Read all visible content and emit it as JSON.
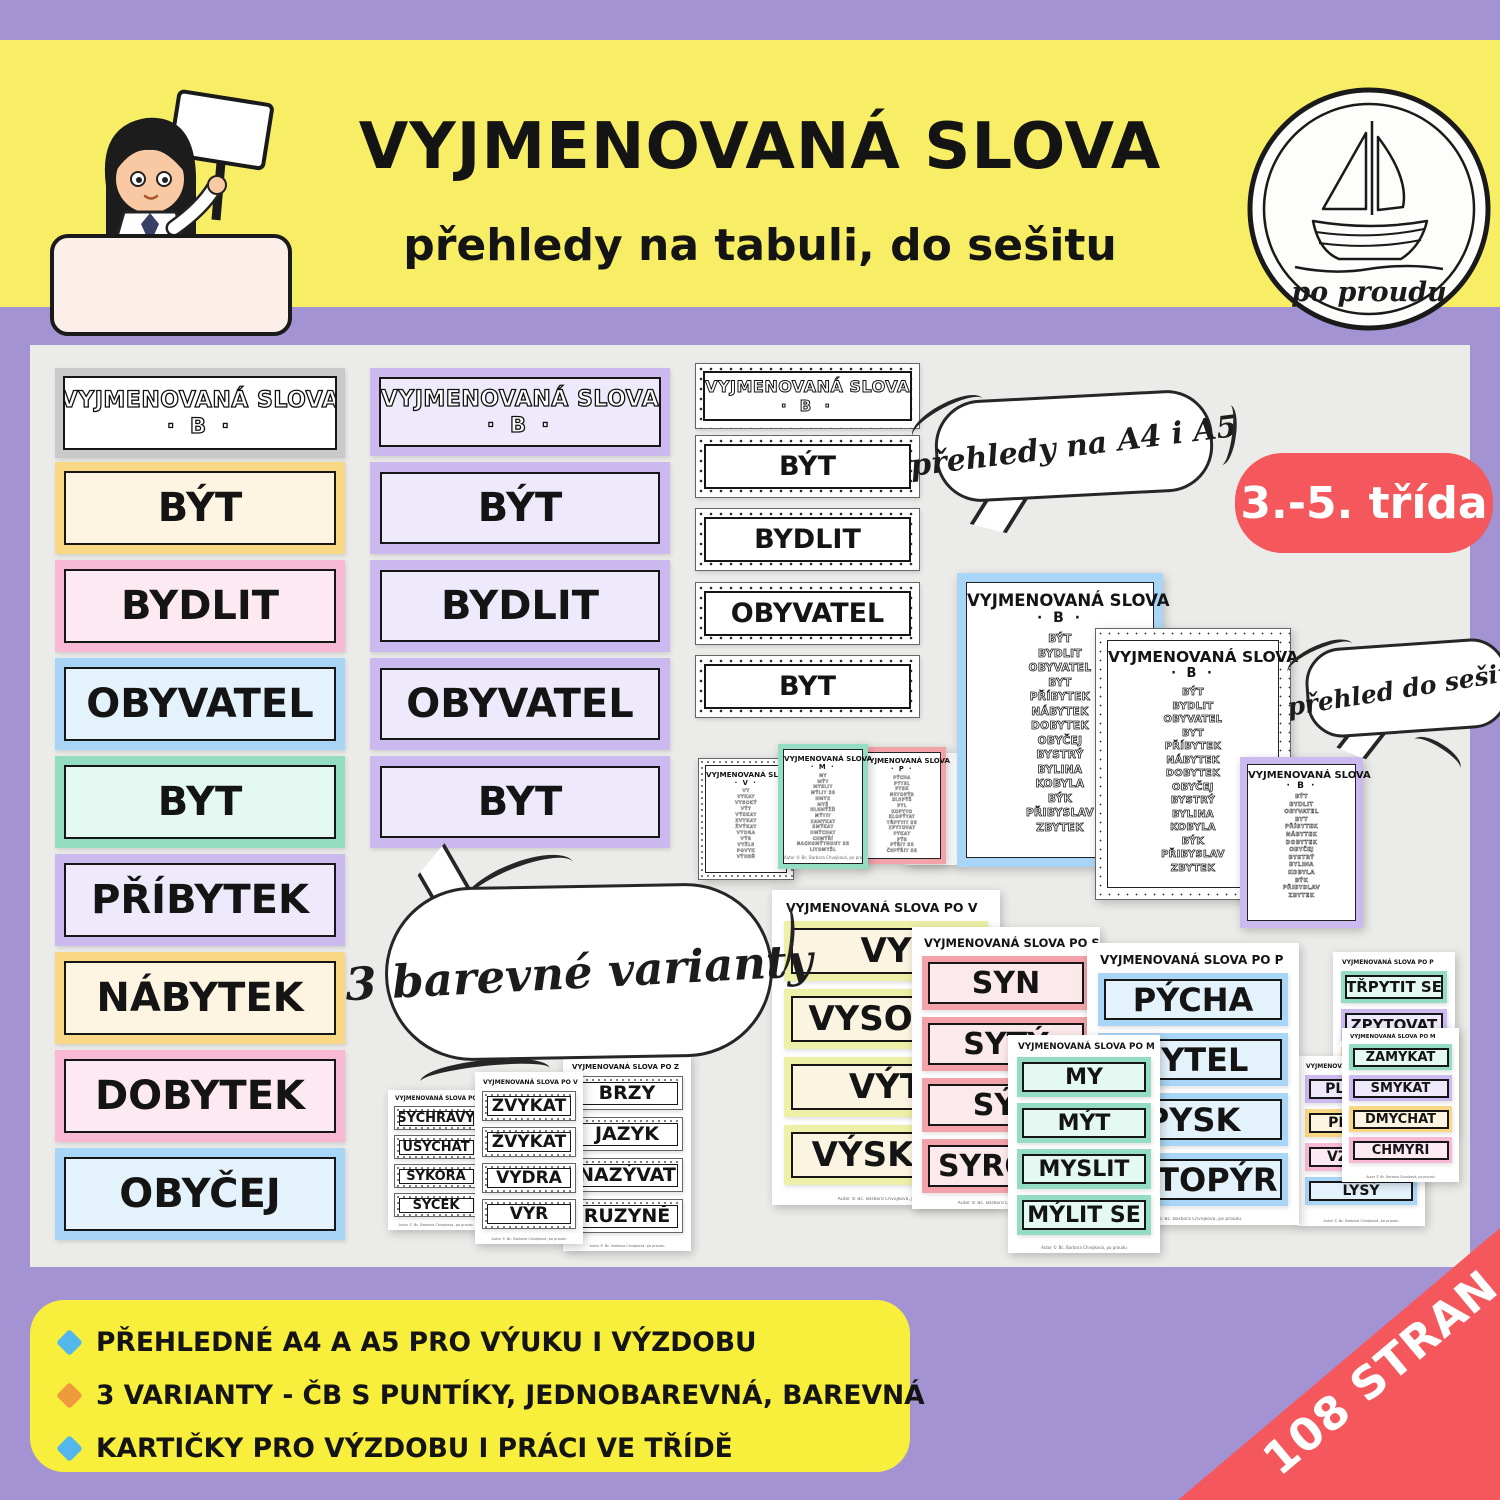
{
  "header": {
    "title": "VYJMENOVANÁ SLOVA",
    "subtitle": "přehledy na tabuli, do sešitu",
    "logo_text": "po proudu"
  },
  "grade_badge": "3.-5. třída",
  "pages_ribbon": "108 STRAN",
  "bubbles": {
    "formats": "přehledy na A4 i A5",
    "notebook": "přehled do sešitu",
    "variants": "3 barevné varianty"
  },
  "header_card": {
    "title": "VYJMENOVANÁ SLOVA",
    "letter": "· B ·"
  },
  "b_words": [
    "BÝT",
    "BYDLIT",
    "OBYVATEL",
    "BYT",
    "PŘÍBYTEK",
    "NÁBYTEK",
    "DOBYTEK",
    "OBYČEJ"
  ],
  "overview_b": {
    "title": "VYJMENOVANÁ SLOVA",
    "letter": "· B ·",
    "words": [
      "BÝT",
      "BYDLIT",
      "OBYVATEL",
      "BYT",
      "PŘÍBYTEK",
      "NÁBYTEK",
      "DOBYTEK",
      "OBYČEJ",
      "BYSTRÝ",
      "BYLINA",
      "KOBYLA",
      "BÝK",
      "PŘIBYSLAV",
      "ZBYTEK"
    ]
  },
  "mini_overviews": {
    "v": {
      "title": "VYJMENOVANÁ SLOVA",
      "letter": "· V ·",
      "words": [
        "VY",
        "VYKAT",
        "VYSOKÝ",
        "VÝT",
        "VÝSKAT",
        "ZVYKAT",
        "ŽVÝKAT",
        "VYDRA",
        "VÝR",
        "VYŽLE",
        "POVYK",
        "VÝHEŇ"
      ]
    },
    "m": {
      "title": "VYJMENOVANÁ SLOVA",
      "letter": "· M ·",
      "words": [
        "MY",
        "MÝT",
        "MYSLIT",
        "MÝLIT SE",
        "HMYZ",
        "MYŠ",
        "HLEMÝŽĎ",
        "MÝTIT",
        "ZAMYKAT",
        "SMÝKAT",
        "DMÝCHAT",
        "CHMÝŘÍ",
        "NACHOMÝTNOUT SE",
        "LITOMYŠL"
      ]
    },
    "p": {
      "title": "VYJMENOVANÁ SLOVA",
      "letter": "· P ·",
      "words": [
        "PÝCHA",
        "PYTEL",
        "PYSK",
        "NETOPÝR",
        "SLEPÝŠ",
        "PYL",
        "KOPYTO",
        "KLOPÝTAT",
        "TŘPYTIT SE",
        "ZPYTOVAT",
        "PYKAT",
        "PÝR",
        "PÝŘIT SE",
        "ČEPÝŘIT SE"
      ]
    }
  },
  "color_sheets": {
    "v": {
      "title": "VYJMENOVANÁ SLOVA PO V",
      "words": [
        "VY",
        "VYSOKÝ",
        "VÝT",
        "VÝSKAT"
      ]
    },
    "s": {
      "title": "VYJMENOVANÁ SLOVA PO S",
      "words": [
        "SYN",
        "SYTÝ",
        "SÝR",
        "SYROVÝ"
      ]
    },
    "m": {
      "title": "VYJMENOVANÁ SLOVA PO M",
      "words": [
        "MY",
        "MÝT",
        "MYSLIT",
        "MÝLIT SE"
      ]
    },
    "p": {
      "title": "VYJMENOVANÁ SLOVA PO P",
      "words": [
        "PÝCHA",
        "PYTEL",
        "PYSK",
        "NETOPÝR"
      ]
    }
  },
  "bw_sheets": {
    "s": {
      "title": "VYJMENOVANÁ SLOVA PO S",
      "words": [
        "SYCHRAVÝ",
        "USYCHAT",
        "SÝKORA",
        "SÝČEK"
      ]
    },
    "v": {
      "title": "VYJMENOVANÁ SLOVA PO V",
      "words": [
        "ZVYKAT",
        "ŽVÝKAT",
        "VYDRA",
        "VÝR"
      ]
    },
    "z": {
      "title": "VYJMENOVANÁ SLOVA PO Z",
      "words": [
        "BRZY",
        "JAZYK",
        "NAZÝVAT",
        "RUZYNĚ"
      ]
    }
  },
  "pastel_sheets": {
    "p": {
      "title": "VYJMENOVANÁ SLOVA PO P",
      "words": [
        "TŘPYTIT SE",
        "ZPYTOVAT",
        "PYKAT"
      ]
    },
    "l": {
      "title": "VYJMENOVANÁ SLOVA PO L",
      "words": [
        "PLYNOUT",
        "PLÝTVAT",
        "VZLYKAT",
        "LYSÝ"
      ]
    },
    "m": {
      "title": "VYJMENOVANÁ SLOVA PO M",
      "words": [
        "ZAMYKAT",
        "SMÝKAT",
        "DMÝCHAT",
        "CHMÝŘÍ"
      ]
    }
  },
  "features": {
    "items": [
      "PŘEHLEDNÉ A4 A A5 PRO VÝUKU I VÝZDOBU",
      "3 VARIANTY - ČB S PUNTÍKY, JEDNOBAREVNÁ, BAREVNÁ",
      "KARTIČKY PRO VÝZDOBU I PRÁCI VE TŘÍDĚ"
    ]
  },
  "sheet_footer": "Autor © Bc. Barbora Chvojková, po proudu",
  "colors": {
    "banner_yellow": "#f8ee66",
    "background_purple": "#a493d3",
    "content_gray": "#ebebe9",
    "badge_red": "#f4575c",
    "diamond_blue": "#53b7ec",
    "diamond_orange": "#f09a3e",
    "card_yellow": "#f9d784",
    "card_pink": "#f7b9d3",
    "card_blue": "#a9d5f6",
    "card_mint": "#94dcc2",
    "card_purple": "#cbb9ef"
  }
}
